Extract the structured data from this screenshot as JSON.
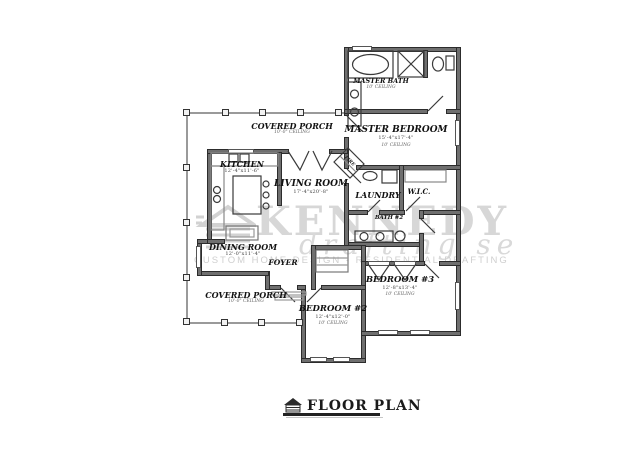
{
  "watermark": {
    "name": "KENNEDY",
    "script": "drafting se",
    "tagline": "CUSTOM HOME DESIGN - RESIDENTIAL DRAFTING"
  },
  "title_block": {
    "label": "FLOOR PLAN"
  },
  "colors": {
    "wall": "#6f6f6f",
    "line": "#2c2c2c",
    "watermark": "#d7d7d7"
  },
  "rooms": {
    "covered_porch_top": {
      "label": "COVERED PORCH",
      "ceiling": "10'-0\" CEILING"
    },
    "master_bath": {
      "label": "MASTER BATH",
      "ceiling": "10' CEILING"
    },
    "master_bedroom": {
      "label": "MASTER BEDROOM",
      "dims": "15'-4\"x17'-4\"",
      "ceiling": "10' CEILING"
    },
    "kitchen": {
      "label": "KITCHEN",
      "dims": "12'-4\"x11'-6\""
    },
    "living_room": {
      "label": "LIVING ROOM",
      "dims": "17'-4\"x20'-8\""
    },
    "laundry": {
      "label": "LAUNDRY"
    },
    "wic": {
      "label": "W.I.C."
    },
    "bath_2": {
      "label": "BATH #2"
    },
    "dining_room": {
      "label": "DINING ROOM",
      "dims": "12'-0\"x11'-4\""
    },
    "foyer": {
      "label": "FOYER"
    },
    "covered_porch_bottom": {
      "label": "COVERED PORCH",
      "ceiling": "10'-0\" CEILING"
    },
    "bedroom_2": {
      "label": "BEDROOM #2",
      "dims": "12'-4\"x12'-0\"",
      "ceiling": "10' CEILING"
    },
    "bedroom_3": {
      "label": "BEDROOM #3",
      "dims": "12'-8\"x13'-4\"",
      "ceiling": "10' CEILING"
    },
    "fireplace": {
      "label": "FIRE"
    }
  }
}
